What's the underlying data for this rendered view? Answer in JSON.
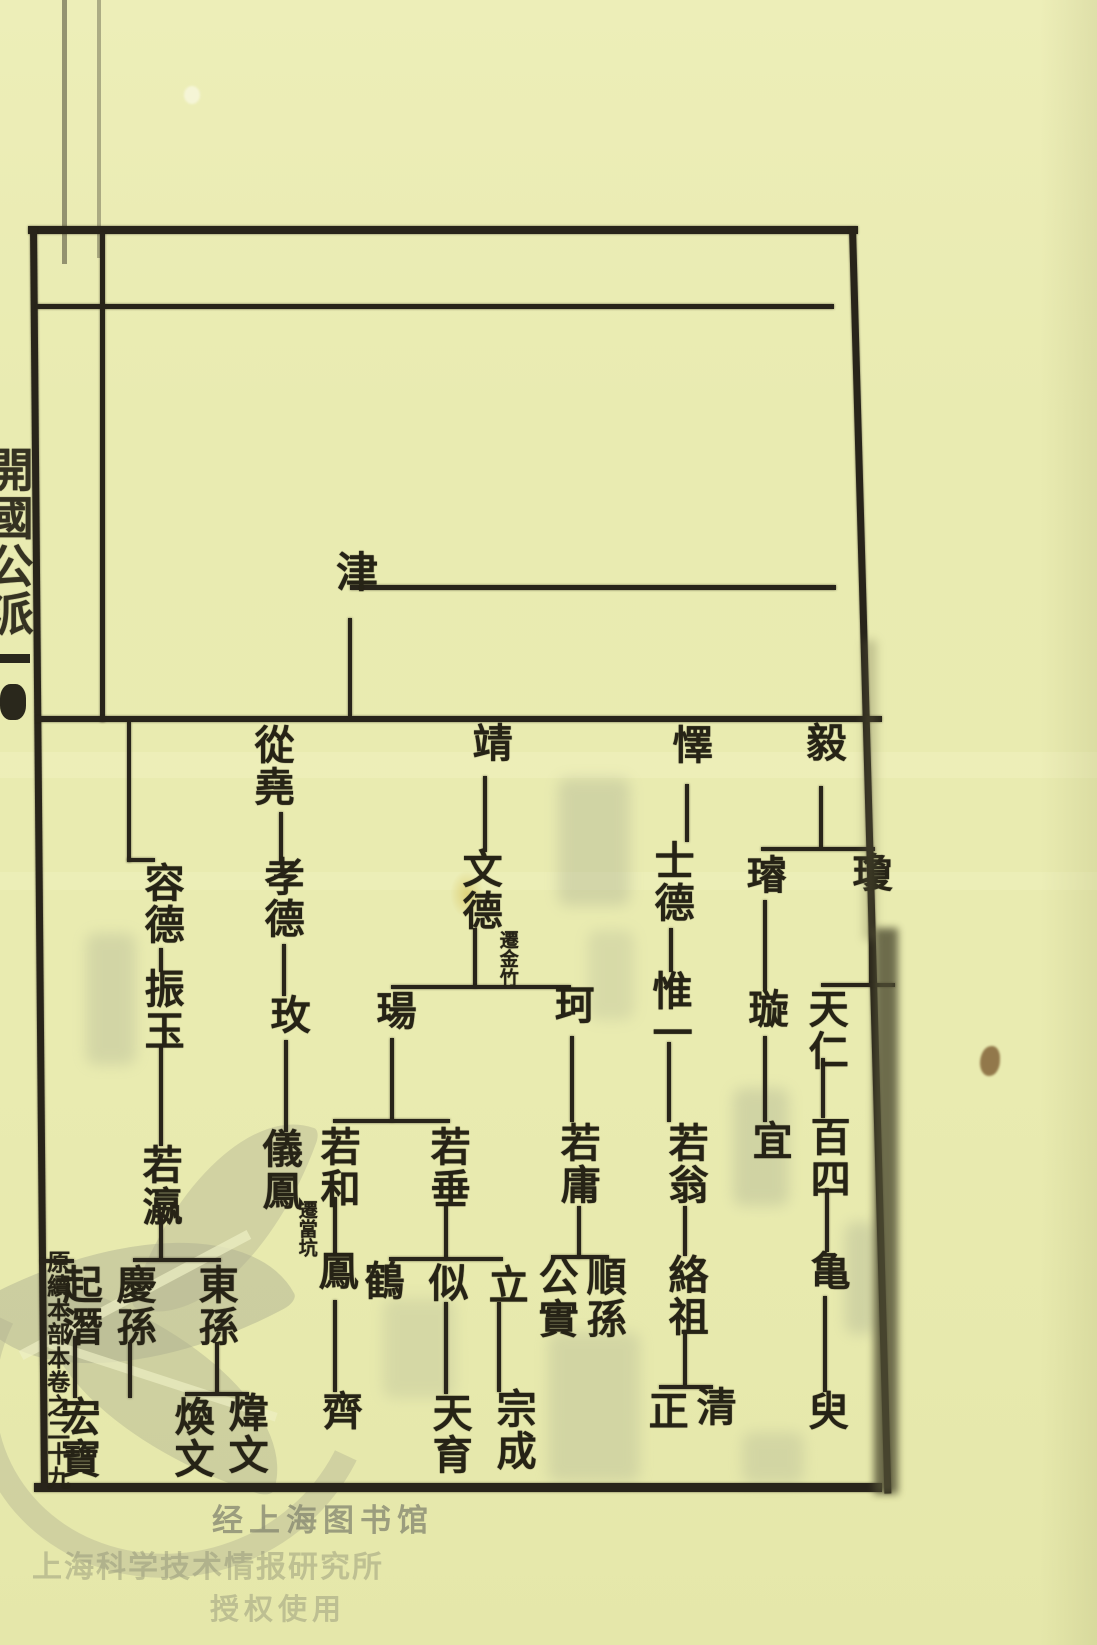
{
  "page": {
    "spine_label": "開國公派",
    "margin_label": "原續本部本卷之二十九"
  },
  "watermark": {
    "line1": "经上海图书馆",
    "line2": "上海科学技术情报研究所",
    "line3": "授权使用"
  },
  "chart_data": {
    "type": "diagram",
    "diagram": "genealogy-family-tree",
    "orientation": "vertical text columns, generations top-to-bottom, siblings read right-to-left",
    "progenitor": "津",
    "relations": [
      {
        "parent": "津",
        "children": [
          "毅",
          "懌",
          "靖",
          "從堯",
          "容德"
        ]
      },
      {
        "parent": "毅",
        "children": [
          "瓊",
          "璿"
        ]
      },
      {
        "parent": "瓊",
        "children": [
          "天仁"
        ]
      },
      {
        "parent": "天仁",
        "children": [
          "百四"
        ]
      },
      {
        "parent": "百四",
        "children": [
          "亀"
        ]
      },
      {
        "parent": "亀",
        "children": [
          "臾"
        ]
      },
      {
        "parent": "璿",
        "children": [
          "璇"
        ]
      },
      {
        "parent": "璇",
        "children": [
          "宜"
        ]
      },
      {
        "parent": "懌",
        "children": [
          "士德"
        ]
      },
      {
        "parent": "士德",
        "children": [
          "惟一"
        ]
      },
      {
        "parent": "惟一",
        "children": [
          "若翁"
        ]
      },
      {
        "parent": "若翁",
        "children": [
          "絡祖"
        ]
      },
      {
        "parent": "絡祖",
        "children": [
          "清",
          "正"
        ]
      },
      {
        "parent": "靖",
        "children": [
          "文德"
        ]
      },
      {
        "parent": "文德",
        "children": [
          "珂",
          "瑒"
        ]
      },
      {
        "parent": "珂",
        "children": [
          "若庸"
        ]
      },
      {
        "parent": "若庸",
        "children": [
          "順孫",
          "公實"
        ]
      },
      {
        "parent": "瑒",
        "children": [
          "若垂",
          "若和"
        ]
      },
      {
        "parent": "若垂",
        "children": [
          "立",
          "似",
          "鶴"
        ]
      },
      {
        "parent": "立",
        "children": [
          "宗成"
        ]
      },
      {
        "parent": "似",
        "children": [
          "天育"
        ]
      },
      {
        "parent": "若和",
        "children": [
          "鳳"
        ]
      },
      {
        "parent": "鳳",
        "children": [
          "齊"
        ]
      },
      {
        "parent": "從堯",
        "children": [
          "孝德"
        ]
      },
      {
        "parent": "孝德",
        "children": [
          "玫"
        ]
      },
      {
        "parent": "玫",
        "children": [
          "儀鳳"
        ]
      },
      {
        "parent": "容德",
        "children": [
          "振玉"
        ]
      },
      {
        "parent": "振玉",
        "children": [
          "若瀛"
        ]
      },
      {
        "parent": "若瀛",
        "children": [
          "東孫",
          "慶孫"
        ]
      },
      {
        "parent": "東孫",
        "children": [
          "煒文",
          "煥文"
        ]
      },
      {
        "parent": "起潛",
        "children": [
          "宏寶"
        ]
      }
    ],
    "annotations": [
      {
        "node": "文德",
        "note": "遷金竹"
      },
      {
        "node": "儀鳳",
        "note": "遷當坑"
      }
    ]
  },
  "layout": {
    "nodes": [
      {
        "id": "jin",
        "label": "津",
        "x": 332,
        "y": 550,
        "fs": 42
      },
      {
        "id": "congyao",
        "label": "從堯",
        "x": 250,
        "y": 724,
        "fs": 40
      },
      {
        "id": "jing",
        "label": "靖",
        "x": 468,
        "y": 722,
        "fs": 40
      },
      {
        "id": "yi-duke",
        "label": "懌",
        "x": 668,
        "y": 724,
        "fs": 40
      },
      {
        "id": "yi-gong",
        "label": "毅",
        "x": 802,
        "y": 722,
        "fs": 40
      },
      {
        "id": "rongde",
        "label": "容德",
        "x": 140,
        "y": 862,
        "fs": 40
      },
      {
        "id": "xiaode",
        "label": "孝德",
        "x": 260,
        "y": 856,
        "fs": 40
      },
      {
        "id": "wende",
        "label": "文德",
        "x": 458,
        "y": 848,
        "fs": 40,
        "note": "遷金竹",
        "nx": 497,
        "ny": 930,
        "nfs": 19
      },
      {
        "id": "shide",
        "label": "士德",
        "x": 650,
        "y": 840,
        "fs": 40
      },
      {
        "id": "xuan-jade",
        "label": "璿",
        "x": 742,
        "y": 854,
        "fs": 40
      },
      {
        "id": "qiong",
        "label": "瓊",
        "x": 848,
        "y": 852,
        "fs": 40
      },
      {
        "id": "zhenyu",
        "label": "振玉",
        "x": 140,
        "y": 968,
        "fs": 40
      },
      {
        "id": "mei",
        "label": "玫",
        "x": 266,
        "y": 994,
        "fs": 40
      },
      {
        "id": "yang",
        "label": "瑒",
        "x": 372,
        "y": 990,
        "fs": 40
      },
      {
        "id": "ke",
        "label": "珂",
        "x": 550,
        "y": 984,
        "fs": 40
      },
      {
        "id": "weiyi",
        "label": "惟一",
        "x": 648,
        "y": 970,
        "fs": 40
      },
      {
        "id": "xuan-spin",
        "label": "璇",
        "x": 744,
        "y": 988,
        "fs": 40
      },
      {
        "id": "tianren",
        "label": "天仁",
        "x": 804,
        "y": 988,
        "fs": 40
      },
      {
        "id": "ruoying",
        "label": "若瀛",
        "x": 138,
        "y": 1144,
        "fs": 40
      },
      {
        "id": "yifeng",
        "label": "儀鳳",
        "x": 258,
        "y": 1128,
        "fs": 40,
        "note": "遷當坑",
        "nx": 296,
        "ny": 1200,
        "nfs": 19
      },
      {
        "id": "ruohe",
        "label": "若和",
        "x": 316,
        "y": 1126,
        "fs": 40
      },
      {
        "id": "ruochui",
        "label": "若垂",
        "x": 426,
        "y": 1126,
        "fs": 40
      },
      {
        "id": "ruoyong",
        "label": "若庸",
        "x": 556,
        "y": 1122,
        "fs": 40
      },
      {
        "id": "ruoweng",
        "label": "若翁",
        "x": 664,
        "y": 1122,
        "fs": 40
      },
      {
        "id": "yi-proper",
        "label": "宜",
        "x": 748,
        "y": 1120,
        "fs": 40
      },
      {
        "id": "baisi",
        "label": "百四",
        "x": 806,
        "y": 1116,
        "fs": 40
      },
      {
        "id": "qingsun",
        "label": "慶孫",
        "x": 112,
        "y": 1264,
        "fs": 40
      },
      {
        "id": "dongsun",
        "label": "東孫",
        "x": 194,
        "y": 1264,
        "fs": 40
      },
      {
        "id": "feng",
        "label": "鳳",
        "x": 314,
        "y": 1250,
        "fs": 40
      },
      {
        "id": "he",
        "label": "鶴",
        "x": 360,
        "y": 1260,
        "fs": 40
      },
      {
        "id": "si",
        "label": "似",
        "x": 424,
        "y": 1262,
        "fs": 40
      },
      {
        "id": "li",
        "label": "立",
        "x": 484,
        "y": 1264,
        "fs": 40
      },
      {
        "id": "gongshi",
        "label": "公實",
        "x": 534,
        "y": 1256,
        "fs": 40
      },
      {
        "id": "shunsun",
        "label": "順孫",
        "x": 582,
        "y": 1256,
        "fs": 40
      },
      {
        "id": "luozu",
        "label": "絡祖",
        "x": 664,
        "y": 1254,
        "fs": 40
      },
      {
        "id": "gui",
        "label": "亀",
        "x": 806,
        "y": 1250,
        "fs": 40
      },
      {
        "id": "qiqian",
        "label": "起潛",
        "x": 58,
        "y": 1264,
        "fs": 40
      },
      {
        "id": "hongbao",
        "label": "宏寶",
        "x": 56,
        "y": 1396,
        "fs": 40
      },
      {
        "id": "huanwen",
        "label": "煥文",
        "x": 170,
        "y": 1396,
        "fs": 40
      },
      {
        "id": "weiwen",
        "label": "煒文",
        "x": 224,
        "y": 1392,
        "fs": 40
      },
      {
        "id": "qi",
        "label": "齊",
        "x": 318,
        "y": 1390,
        "fs": 40
      },
      {
        "id": "tianyu",
        "label": "天育",
        "x": 428,
        "y": 1392,
        "fs": 40
      },
      {
        "id": "zongcheng",
        "label": "宗成",
        "x": 492,
        "y": 1388,
        "fs": 40
      },
      {
        "id": "zheng",
        "label": "正",
        "x": 644,
        "y": 1390,
        "fs": 40
      },
      {
        "id": "qing",
        "label": "清",
        "x": 692,
        "y": 1386,
        "fs": 40
      },
      {
        "id": "yu",
        "label": "臾",
        "x": 804,
        "y": 1390,
        "fs": 40
      }
    ],
    "segments": [
      {
        "id": "border-top",
        "x": 28,
        "y": 226,
        "w": 830,
        "h": 8
      },
      {
        "id": "border-left",
        "x": 30,
        "y": 228,
        "w": 7,
        "h": 1262,
        "rot": -0.5,
        "o": "top left"
      },
      {
        "id": "border-right",
        "x": 849,
        "y": 228,
        "w": 7,
        "h": 1266,
        "rot": -1.6,
        "o": "top center"
      },
      {
        "id": "border-bottom",
        "x": 34,
        "y": 1483,
        "w": 848,
        "h": 9
      },
      {
        "id": "inner-left-rule",
        "x": 100,
        "y": 232,
        "w": 5,
        "h": 490
      },
      {
        "id": "top-section-rule",
        "x": 36,
        "y": 304,
        "w": 798,
        "h": 5
      },
      {
        "id": "jin-generation-rule",
        "x": 350,
        "y": 585,
        "w": 486,
        "h": 5
      },
      {
        "id": "jin-descent",
        "x": 348,
        "y": 618,
        "w": 4,
        "h": 98
      },
      {
        "id": "gen2-rule",
        "x": 36,
        "y": 716,
        "w": 846,
        "h": 6
      },
      {
        "id": "congyao-descent",
        "x": 279,
        "y": 812,
        "w": 4,
        "h": 50
      },
      {
        "id": "xiaode-descent",
        "x": 282,
        "y": 944,
        "w": 4,
        "h": 52
      },
      {
        "id": "mei-descent",
        "x": 284,
        "y": 1040,
        "w": 4,
        "h": 92
      },
      {
        "id": "rongde-elbow-v",
        "x": 127,
        "y": 722,
        "w": 4,
        "h": 140
      },
      {
        "id": "rongde-elbow-h",
        "x": 127,
        "y": 858,
        "w": 28,
        "h": 4
      },
      {
        "id": "rongde-descent",
        "x": 159,
        "y": 948,
        "w": 4,
        "h": 24
      },
      {
        "id": "zhenyu-descent",
        "x": 159,
        "y": 1046,
        "w": 4,
        "h": 100
      },
      {
        "id": "ruoying-descent",
        "x": 159,
        "y": 1212,
        "w": 4,
        "h": 48
      },
      {
        "id": "qingsun-dongsun-bracket",
        "x": 133,
        "y": 1258,
        "w": 88,
        "h": 4
      },
      {
        "id": "qingsun-tail",
        "x": 128,
        "y": 1342,
        "w": 4,
        "h": 56
      },
      {
        "id": "dongsun-descent",
        "x": 215,
        "y": 1342,
        "w": 4,
        "h": 52
      },
      {
        "id": "huanwen-weiwen-bracket",
        "x": 185,
        "y": 1392,
        "w": 64,
        "h": 4
      },
      {
        "id": "qiqian-elbow-h",
        "x": 40,
        "y": 1259,
        "w": 34,
        "h": 4
      },
      {
        "id": "qiqian-descent",
        "x": 73,
        "y": 1336,
        "w": 4,
        "h": 62
      },
      {
        "id": "jing-descent",
        "x": 483,
        "y": 776,
        "w": 4,
        "h": 76
      },
      {
        "id": "wende-tail",
        "x": 473,
        "y": 928,
        "w": 4,
        "h": 60
      },
      {
        "id": "yang-ke-branch",
        "x": 391,
        "y": 985,
        "w": 180,
        "h": 4
      },
      {
        "id": "yang-descent",
        "x": 390,
        "y": 1038,
        "w": 4,
        "h": 84
      },
      {
        "id": "ruohe-ruochui-bracket",
        "x": 333,
        "y": 1119,
        "w": 117,
        "h": 4
      },
      {
        "id": "ruohe-descent",
        "x": 333,
        "y": 1197,
        "w": 4,
        "h": 58
      },
      {
        "id": "feng-descent",
        "x": 333,
        "y": 1300,
        "w": 4,
        "h": 92
      },
      {
        "id": "ruochui-descent",
        "x": 444,
        "y": 1202,
        "w": 4,
        "h": 58
      },
      {
        "id": "he-si-li-bracket",
        "x": 389,
        "y": 1257,
        "w": 114,
        "h": 4
      },
      {
        "id": "si-descent",
        "x": 444,
        "y": 1302,
        "w": 4,
        "h": 92
      },
      {
        "id": "li-descent",
        "x": 497,
        "y": 1302,
        "w": 4,
        "h": 90
      },
      {
        "id": "ke-descent",
        "x": 570,
        "y": 1036,
        "w": 4,
        "h": 86
      },
      {
        "id": "ruoyong-descent",
        "x": 577,
        "y": 1206,
        "w": 4,
        "h": 52
      },
      {
        "id": "gongshi-shunsun-bracket",
        "x": 551,
        "y": 1255,
        "w": 58,
        "h": 4
      },
      {
        "id": "yiduke-descent",
        "x": 685,
        "y": 784,
        "w": 4,
        "h": 58
      },
      {
        "id": "shide-descent",
        "x": 669,
        "y": 928,
        "w": 4,
        "h": 44
      },
      {
        "id": "weiyi-descent",
        "x": 667,
        "y": 1042,
        "w": 4,
        "h": 80
      },
      {
        "id": "ruoweng-descent",
        "x": 683,
        "y": 1206,
        "w": 4,
        "h": 50
      },
      {
        "id": "luozu-descent",
        "x": 683,
        "y": 1330,
        "w": 4,
        "h": 56
      },
      {
        "id": "zheng-qing-bracket",
        "x": 659,
        "y": 1385,
        "w": 54,
        "h": 4
      },
      {
        "id": "yigong-descent",
        "x": 819,
        "y": 786,
        "w": 4,
        "h": 62
      },
      {
        "id": "xuan-qiong-bracket",
        "x": 761,
        "y": 847,
        "w": 114,
        "h": 4
      },
      {
        "id": "xuanjade-descent",
        "x": 763,
        "y": 900,
        "w": 4,
        "h": 90
      },
      {
        "id": "xuanspin-descent",
        "x": 763,
        "y": 1036,
        "w": 4,
        "h": 86
      },
      {
        "id": "qiong-descent",
        "x": 869,
        "y": 900,
        "w": 4,
        "h": 86
      },
      {
        "id": "qiong-elbow-h",
        "x": 821,
        "y": 983,
        "w": 74,
        "h": 4
      },
      {
        "id": "tianren-descent",
        "x": 821,
        "y": 1058,
        "w": 4,
        "h": 60
      },
      {
        "id": "baisi-descent",
        "x": 825,
        "y": 1188,
        "w": 4,
        "h": 64
      },
      {
        "id": "gui-descent",
        "x": 823,
        "y": 1296,
        "w": 4,
        "h": 96
      }
    ],
    "ghosts": [
      {
        "x": 558,
        "y": 778,
        "w": 72,
        "h": 128,
        "o": 0.3
      },
      {
        "x": 86,
        "y": 933,
        "w": 50,
        "h": 132,
        "o": 0.28
      },
      {
        "x": 588,
        "y": 930,
        "w": 46,
        "h": 90,
        "o": 0.22
      },
      {
        "x": 733,
        "y": 1088,
        "w": 56,
        "h": 118,
        "o": 0.3
      },
      {
        "x": 548,
        "y": 1332,
        "w": 92,
        "h": 150,
        "o": 0.26
      },
      {
        "x": 383,
        "y": 1298,
        "w": 72,
        "h": 100,
        "o": 0.22
      },
      {
        "x": 845,
        "y": 1222,
        "w": 32,
        "h": 112,
        "o": 0.3
      },
      {
        "x": 742,
        "y": 1432,
        "w": 62,
        "h": 52,
        "o": 0.25
      }
    ]
  }
}
